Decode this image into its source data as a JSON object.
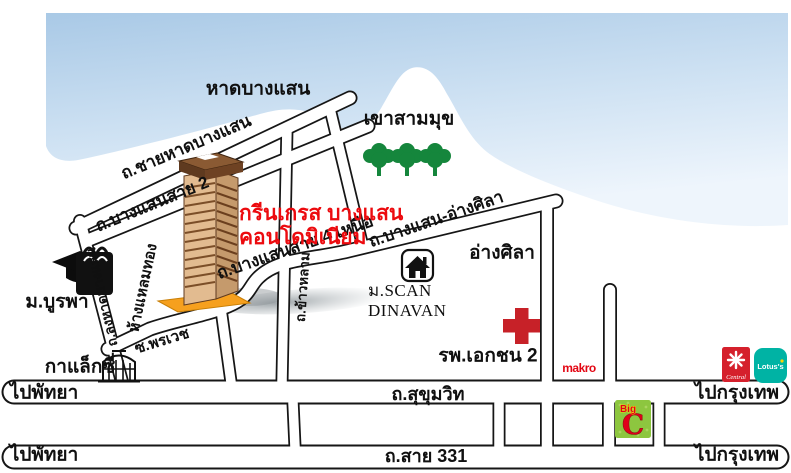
{
  "map_title": {
    "line1": "กรีนเกรส บางแสน",
    "line2": "คอนโดมิเนียม"
  },
  "areas": {
    "beach": "หาดบางแสน",
    "hill": "เขาสามมุข",
    "angsila": "อ่างศิลา"
  },
  "roads": {
    "beach_road": "ถ.ชายหาดบางแสน",
    "bangsaen_sai2": "ถ.บางแสนสาย 2",
    "bangsaen_sai4": "ถ.บางแสนสาย 4 เหนือ",
    "bangsaen_angsila": "ถ.บางแสน-อ่างศิลา",
    "long_had_bangsaen": "ถ.ลงหาดบางแสน",
    "khao_lam": "ถ.ข้าวหลาม",
    "soi_phornwet": "ซ.พรเวช",
    "sukhumvit": "ถ.สุขุมวิท",
    "sai_331": "ถ.สาย 331"
  },
  "directions": {
    "to_pattaya": "ไปพัทยา",
    "to_bangkok": "ไปกรุงเทพ"
  },
  "places": {
    "burapha_university": "ม.บูรพา",
    "laem_thong_mall": "ห้างแหลมทอง",
    "galaxy": "กาแล็กซี่",
    "scan_dinavan_line1": "ม.SCAN",
    "scan_dinavan_line2": "DINAVAN",
    "private_hospital_2": "รพ.เอกชน 2"
  },
  "logos": {
    "makro": "makro",
    "central": "Central",
    "lotus": "Lotus's",
    "bigc_word": "Big",
    "bigc_letter": "C"
  },
  "colors": {
    "title_red": "#ec0a0e",
    "water_blue": "#b7d3ec",
    "tree_green": "#15863c",
    "cross_red": "#c72128",
    "condo_base_orange": "#f6a01e",
    "bigc_green": "#8dc63f",
    "bigc_red": "#e0001a",
    "lotus_teal": "#00b3a4",
    "central_red": "#d5202c",
    "makro_red": "#e30613"
  },
  "icons": [
    "graduation-cap-icon",
    "shopping-bag-icon",
    "tree-icon",
    "house-icon",
    "red-cross-icon",
    "building-icon",
    "condo-tower-icon"
  ]
}
